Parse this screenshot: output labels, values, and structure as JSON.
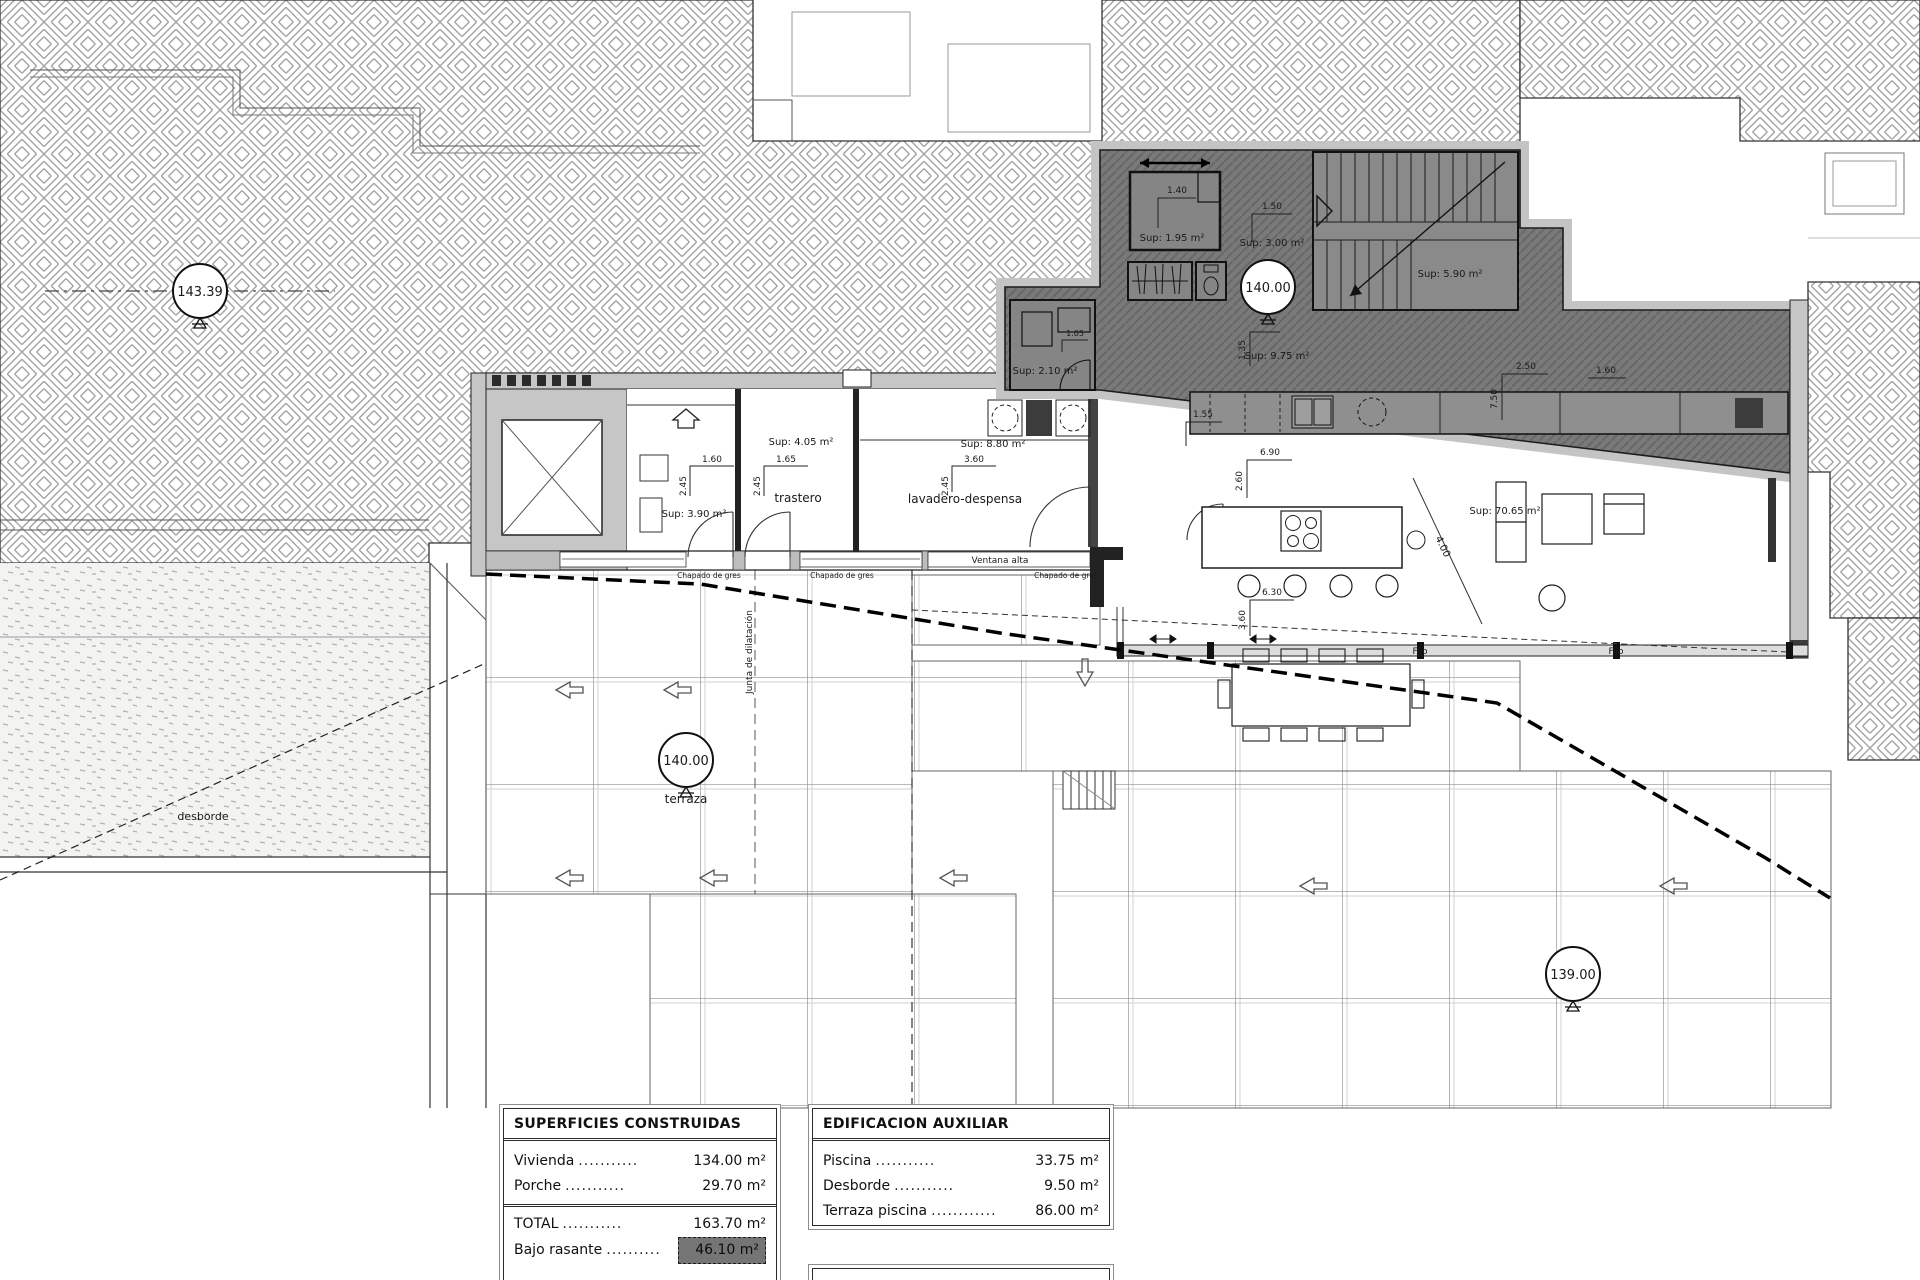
{
  "labels": {
    "markers": {
      "m143": "143.39",
      "m140a": "140.00",
      "m140b": "140.00",
      "m139": "139.00"
    },
    "rooms": {
      "trastero": "trastero",
      "lavadero": "lavadero-despensa",
      "terraza": "terraza",
      "desborde": "desborde"
    },
    "sups": {
      "s195": "Sup: 1.95 m²",
      "s300": "Sup: 3.00 m²",
      "s590": "Sup: 5.90 m²",
      "s975": "Sup: 9.75 m²",
      "s210": "Sup: 2.10 m²",
      "s390": "Sup: 3.90 m²",
      "s405": "Sup: 4.05 m²",
      "s880": "Sup: 8.80 m²",
      "s7065": "Sup: 70.65 m²"
    },
    "notes": {
      "ventana_alta": "Ventana alta",
      "junta": "Junta de dilatación",
      "chapado": "Chapado de gres",
      "fijo": "Fijo"
    },
    "dims": {
      "d160_room1": "1.60",
      "d245_room1": "2.45",
      "d165": "1.65",
      "d245_tra": "2.45",
      "d360_lav": "3.60",
      "d245_lav": "2.45",
      "d140": "1.40",
      "d150": "1.50",
      "d135": "1.35",
      "d105": "1.05",
      "d155": "1.55",
      "d690": "6.90",
      "d260": "2.60",
      "d630": "6.30",
      "d360_din": "3.60",
      "d400": "4.00",
      "d250": "2.50",
      "d750": "7.50",
      "d160_right": "1.60"
    }
  },
  "tables": {
    "superficies": {
      "title": "SUPERFICIES CONSTRUIDAS",
      "rows": [
        {
          "label": "Vivienda",
          "dots": "...........",
          "value": "134.00 m²"
        },
        {
          "label": "Porche",
          "dots": "...........",
          "value": "29.70 m²"
        }
      ],
      "total": {
        "label": "TOTAL",
        "dots": "...........",
        "value": "163.70 m²"
      },
      "bajo": {
        "label": "Bajo rasante",
        "dots": "..........",
        "value": "46.10 m²"
      }
    },
    "auxiliar": {
      "title": "EDIFICACION AUXILIAR",
      "rows": [
        {
          "label": "Piscina",
          "dots": "...........",
          "value": "33.75 m²"
        },
        {
          "label": "Desborde",
          "dots": "...........",
          "value": "9.50 m²"
        },
        {
          "label": "Terraza piscina",
          "dots": "............",
          "value": "86.00 m²"
        }
      ]
    }
  }
}
